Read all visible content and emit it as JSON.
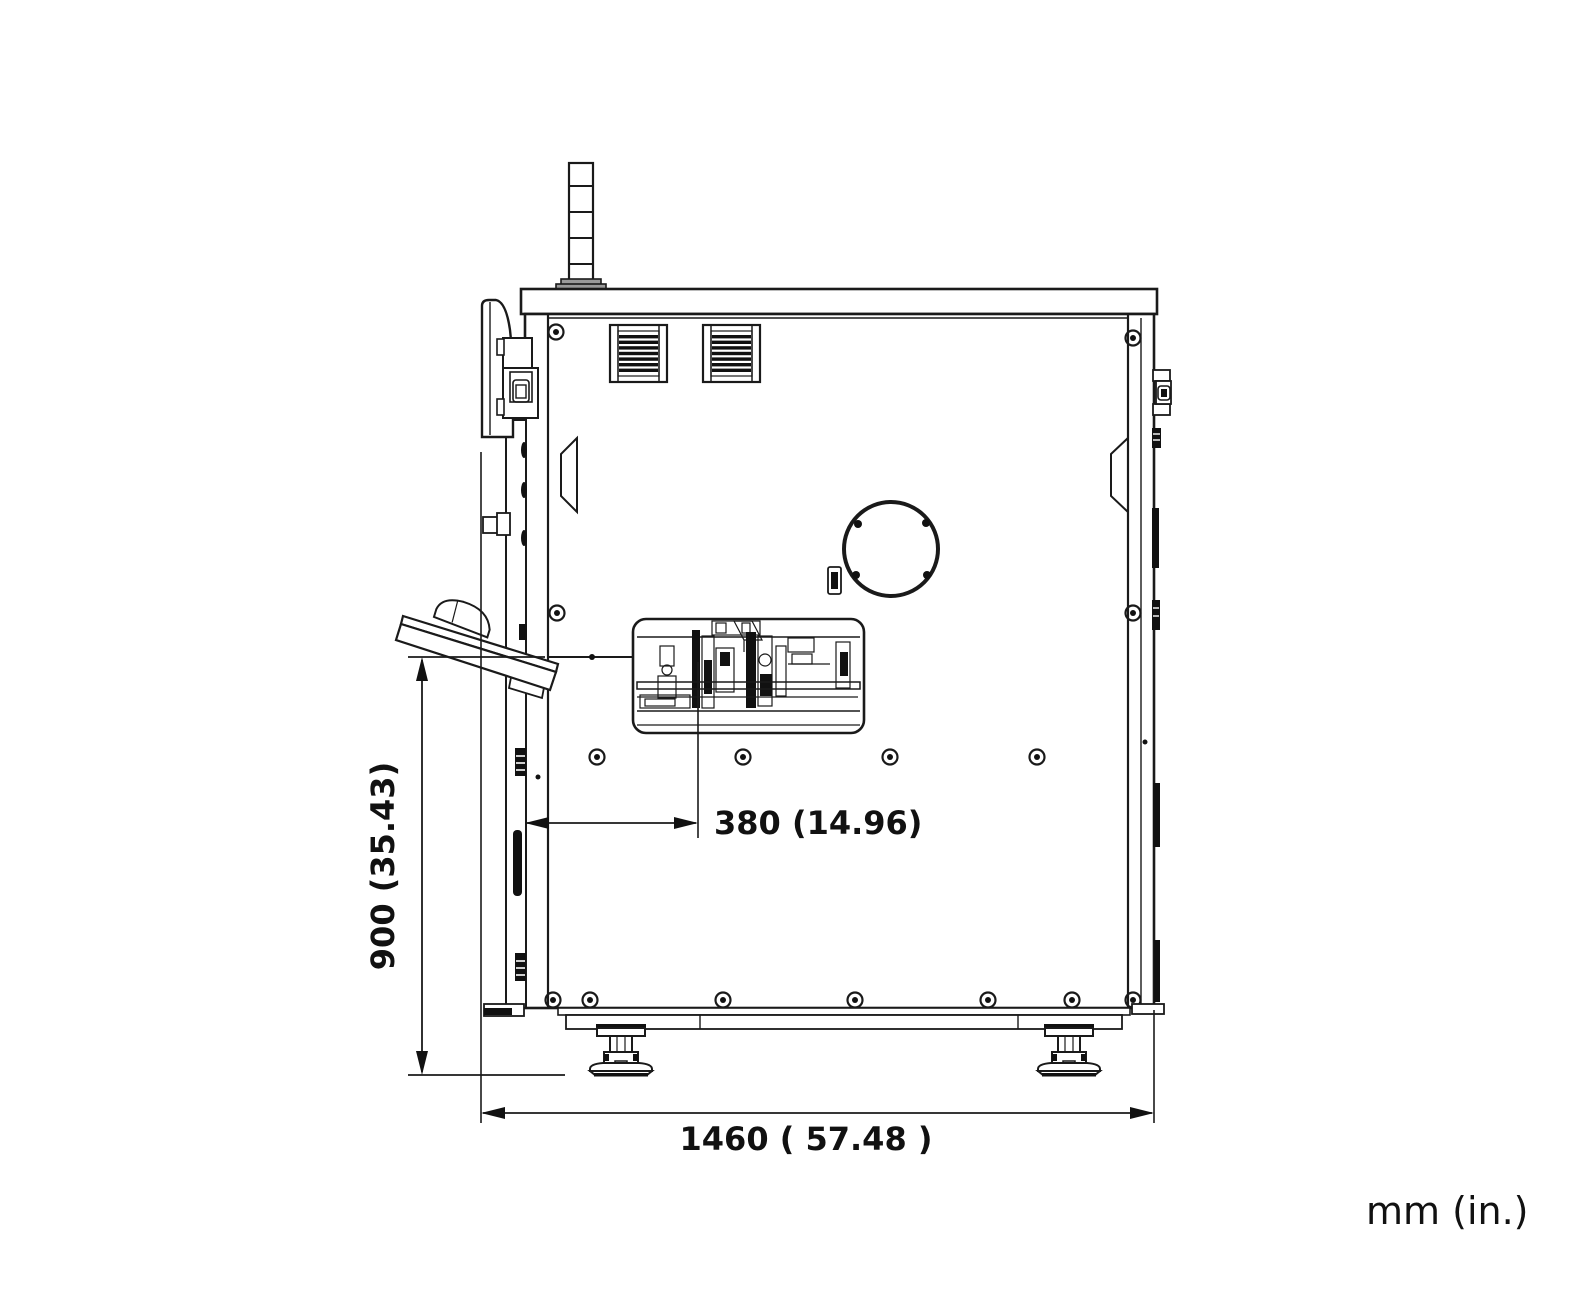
{
  "drawing": {
    "title": "machine side-view dimension drawing",
    "units_label": "mm (in.)",
    "colors": {
      "line": "#1a1a1a",
      "background": "#ffffff"
    },
    "dimensions": [
      {
        "id": "height",
        "label": "900 (35.43)",
        "mm": 900,
        "in": 35.43,
        "orientation": "vertical"
      },
      {
        "id": "offset",
        "label": "380 (14.96)",
        "mm": 380,
        "in": 14.96,
        "orientation": "horizontal"
      },
      {
        "id": "width",
        "label": "1460 ( 57.48 )",
        "mm": 1460,
        "in": 57.48,
        "orientation": "horizontal"
      }
    ]
  }
}
